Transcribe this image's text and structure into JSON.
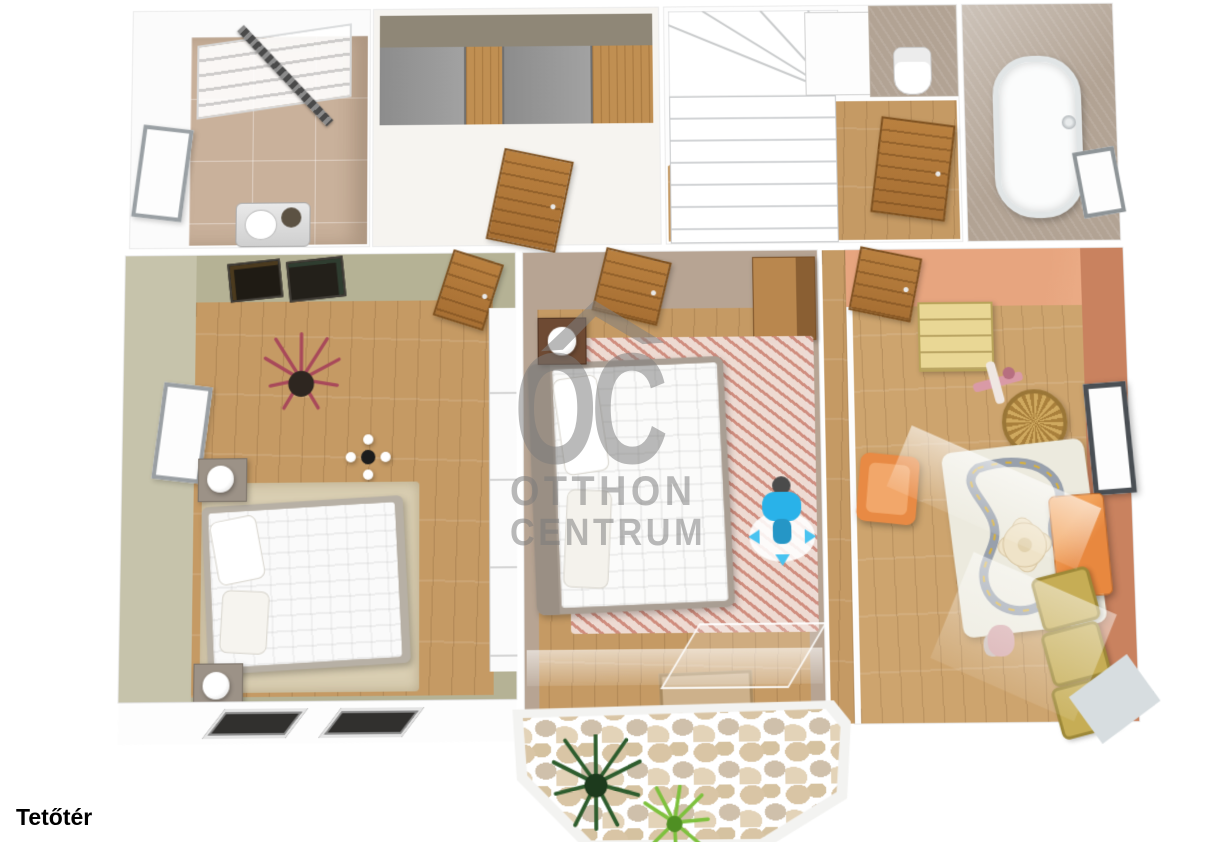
{
  "floor_label": "Tetőtér",
  "watermark": {
    "monogram": "OC",
    "line1": "OTTHON",
    "line2": "CENTRUM",
    "color": "#7a7a7a"
  },
  "scene": {
    "type": "3d-floorplan-top-view",
    "rooms": [
      "laundry-room",
      "walk-in-closet",
      "stair-hall",
      "wc",
      "bathroom",
      "bedroom-left",
      "bedroom-middle",
      "kids-room",
      "balcony"
    ]
  },
  "palette": {
    "background": "#ffffff",
    "wood_floor": "#c59a64",
    "wood_floor_kids": "#cda46e",
    "sage_wall": "#b5b295",
    "taupe_wall": "#b7a493",
    "terracotta_wall": "#e7a57f",
    "terracotta_wall_dark": "#c9825f",
    "tile_tan": "#c9b19b",
    "tile_taupe": "#b2a394",
    "door_wood": "#b9803f",
    "accent_orange": "#e8883f",
    "accent_yellow": "#c6ad55",
    "person_blue": "#29b2e9",
    "watermark_gray": "#7a7a7a"
  }
}
